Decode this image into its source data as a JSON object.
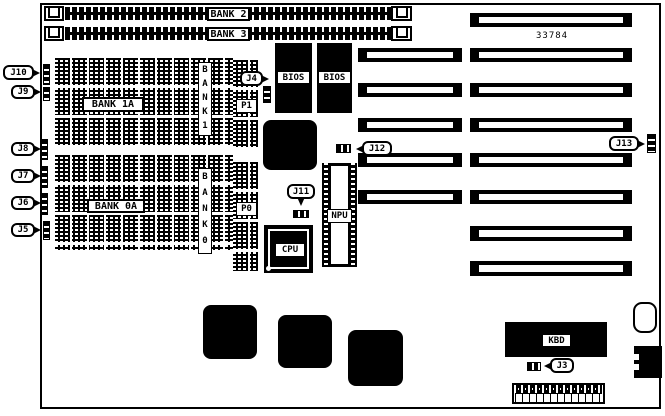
{
  "diagram": {
    "part_number": "33784",
    "memory": {
      "simm_bank2": "BANK 2",
      "simm_bank3": "BANK 3",
      "bank_1a": "BANK 1A",
      "bank_0a": "BANK 0A",
      "bank_1_vertical": "BANK1",
      "bank_0_vertical": "BANK0",
      "p1": "P1",
      "p0": "P0"
    },
    "chips": {
      "bios_1": "BIOS",
      "bios_2": "BIOS",
      "cpu": "CPU",
      "npu": "NPU",
      "keyboard_controller": "KBD"
    },
    "jumpers": {
      "j3": "J3",
      "j4": "J4",
      "j5": "J5",
      "j6": "J6",
      "j7": "J7",
      "j8": "J8",
      "j9": "J9",
      "j10": "J10",
      "j11": "J11",
      "j12": "J12",
      "j13": "J13"
    },
    "colors": {
      "ink": "#000000",
      "paper": "#ffffff"
    }
  }
}
